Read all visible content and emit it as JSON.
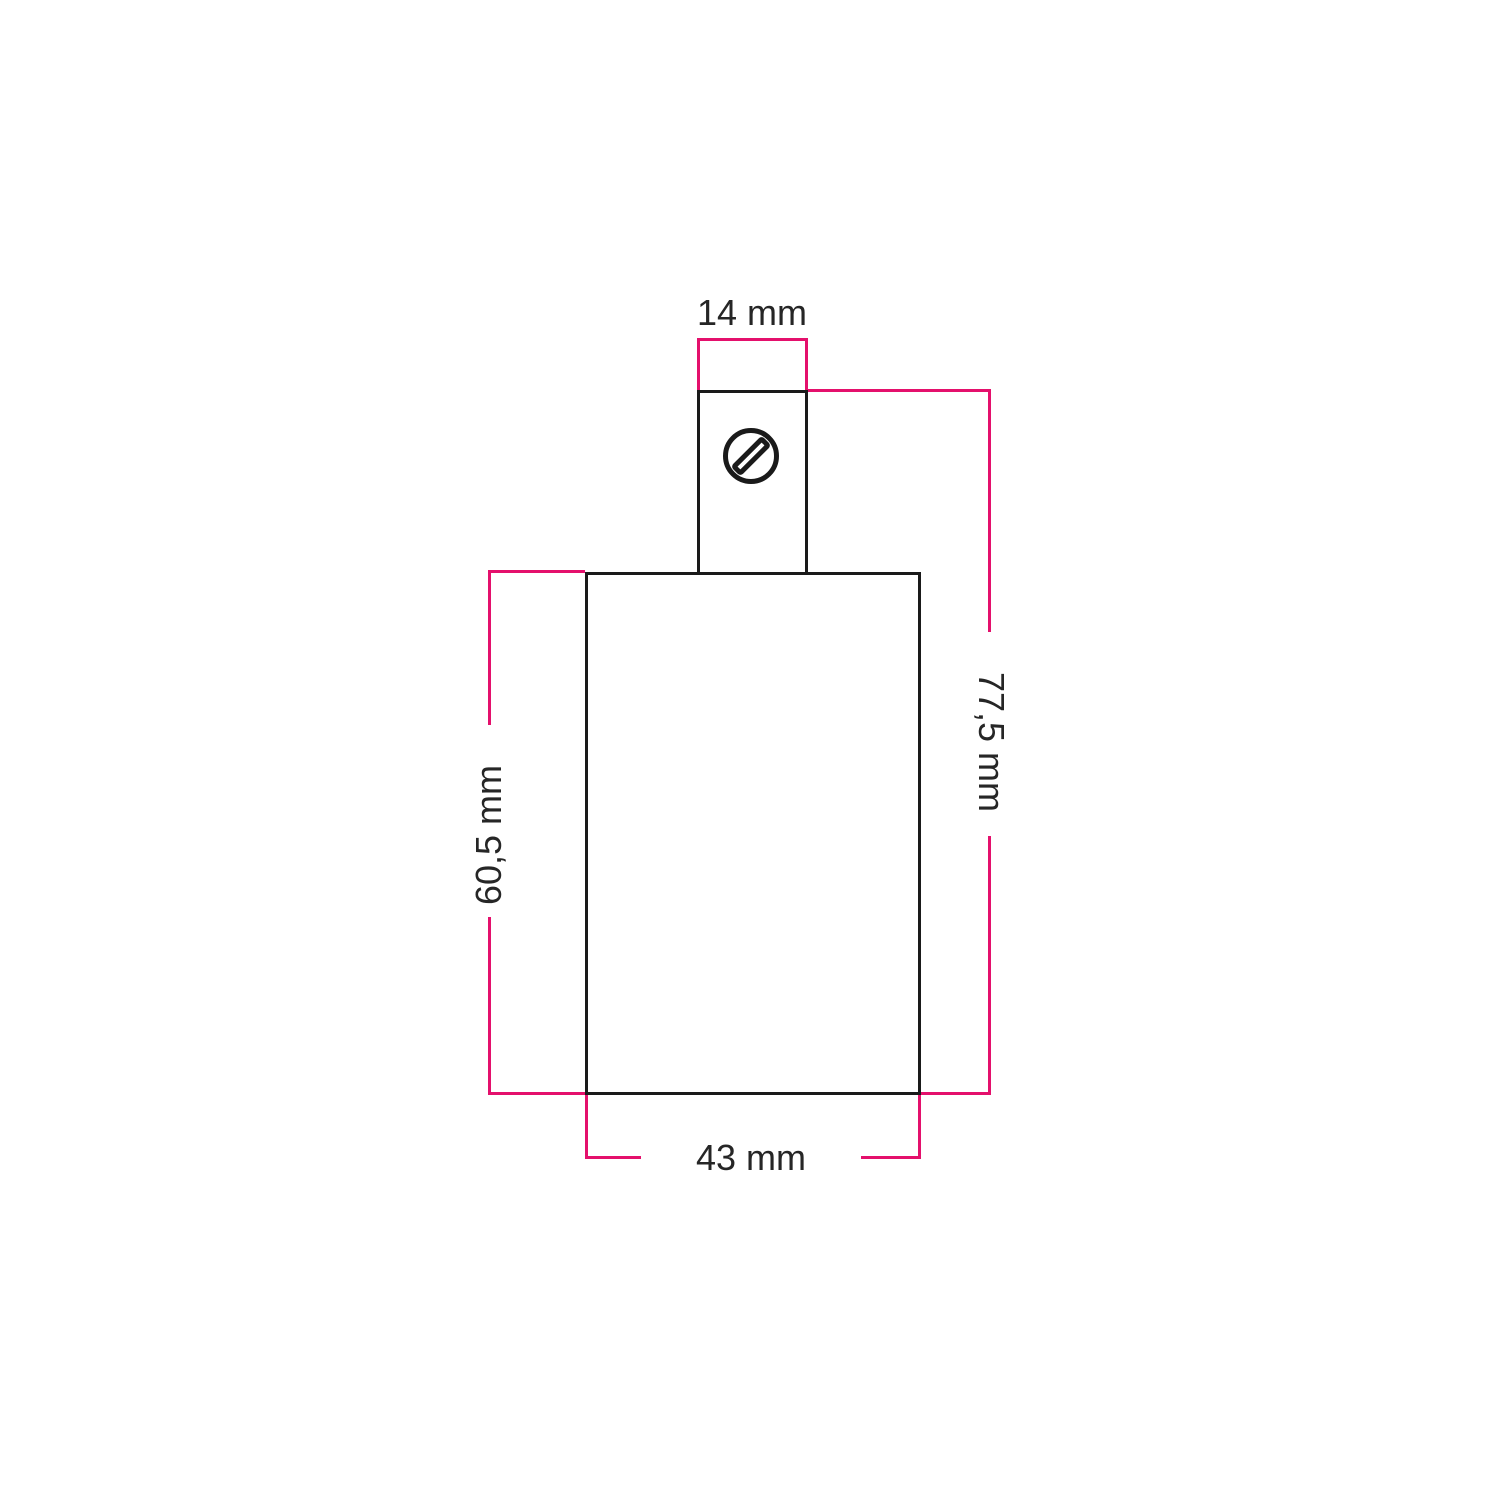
{
  "figure": {
    "type": "technical-dimension-drawing",
    "subject": "cylindrical lamp holder with top cable clamp, front view",
    "colors": {
      "dimension": "#e4106c",
      "outline": "#1a1a1a",
      "text": "#262626",
      "background": "#ffffff"
    },
    "icons": {
      "screw": "slotted-screw-head-top-view"
    },
    "dimensions": {
      "clamp_width": "14 mm",
      "overall_height": "77,5 mm",
      "body_height": "60,5 mm",
      "body_width": "43 mm"
    }
  }
}
